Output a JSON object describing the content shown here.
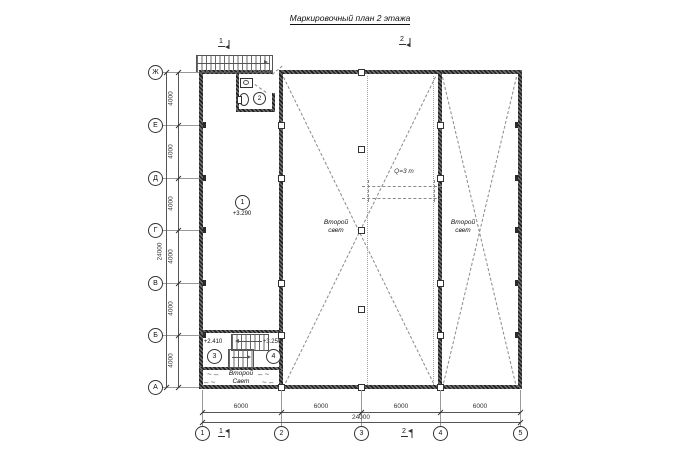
{
  "title": "Маркировочный план 2 этажа",
  "axis": {
    "rows": [
      "Ж",
      "Е",
      "Д",
      "Г",
      "В",
      "Б",
      "А"
    ],
    "cols": [
      "1",
      "2",
      "3",
      "4",
      "5"
    ]
  },
  "dims": {
    "left_segments": [
      "4000",
      "4000",
      "4000",
      "4000",
      "4000",
      "4000"
    ],
    "left_total": "24000",
    "bottom_segments": [
      "6000",
      "6000",
      "6000",
      "6000"
    ],
    "bottom_total": "24000"
  },
  "rooms": {
    "r1": {
      "tag": "1",
      "elevation": "+3.290"
    },
    "r2": {
      "tag": "2"
    },
    "r3": {
      "tag": "3",
      "elevation": "+2.410"
    },
    "r4": {
      "tag": "4",
      "elevation": "+3.250"
    }
  },
  "annotations": {
    "second_light_line1": "Второй",
    "second_light_line2": "свет",
    "second_light_bottom_line1": "Второй",
    "second_light_bottom_line2": "Свет",
    "crane": "Q=3 т"
  },
  "sections": {
    "s1": "1",
    "s2": "2"
  }
}
